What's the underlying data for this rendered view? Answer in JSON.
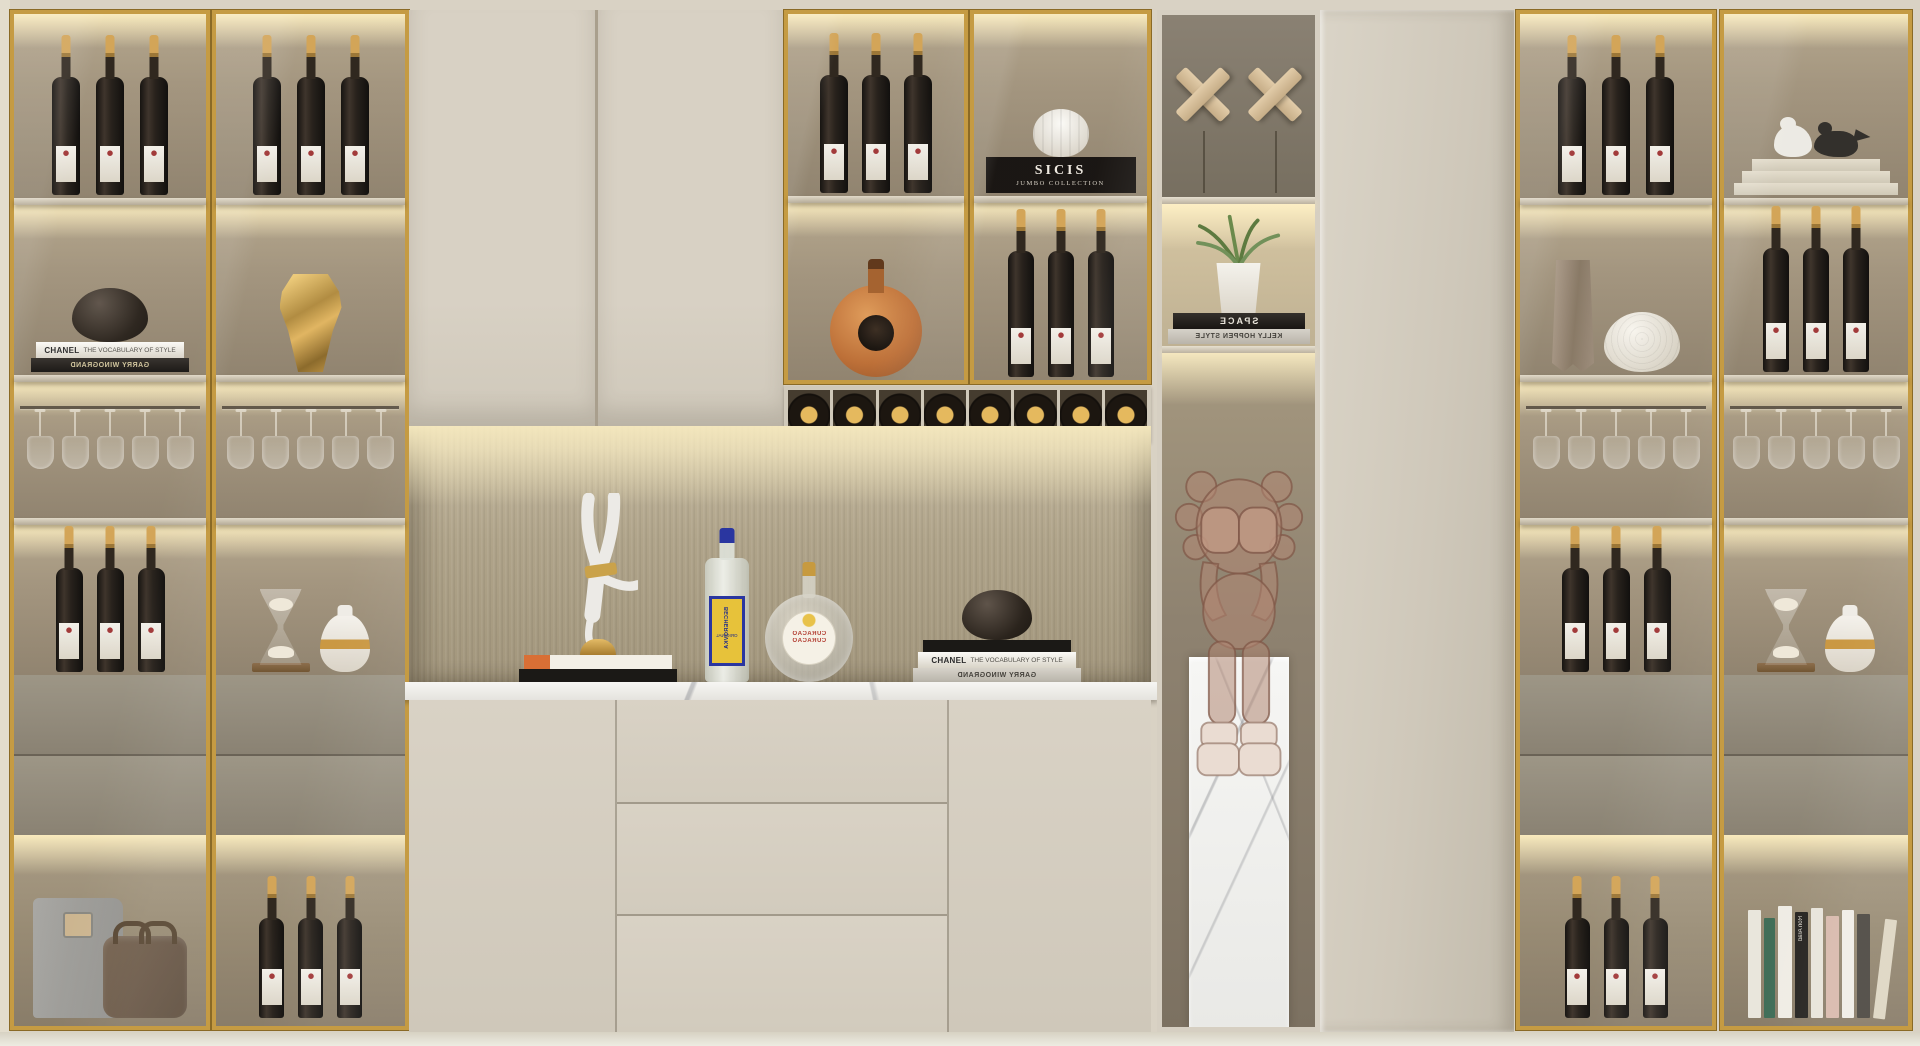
{
  "palette": {
    "wall": "#d9d2c4",
    "cabinet_cream": "#d5cec1",
    "gold_frame": "#c59b43",
    "interior_taupe": "#998b76",
    "drawer_gray": "#8f887a",
    "marble_white": "#f4f4f2",
    "warm_light": "#f6e7b8",
    "becherovka_yellow": "#e7c23a",
    "becherovka_blue": "#2a36a0"
  },
  "texts": {
    "chanel_brand": "CHANEL",
    "chanel_sub": "THE VOCABULARY OF STYLE",
    "garry": "GARRY WINOGRAND",
    "sicis_brand": "SICIS",
    "sicis_sub": "JUMBO COLLECTION",
    "space": "SPACE",
    "kelly": "KELLY HOPPEN STYLE",
    "bech_brand": "BECHEROVKA",
    "bech_sub": "ORIGINAL",
    "curacao": "CURACAO",
    "ron_arad": "Ron Arad"
  },
  "inventory": {
    "left_cabinet_1": [
      "3 red wine bottles",
      "bronze bowl on CHANEL + GARRY WINOGRAND books",
      "5 hanging stem glasses",
      "3 red wine bottles",
      "2 gray drawers",
      "garment bag and leather travel bag"
    ],
    "left_cabinet_2": [
      "3 red wine bottles",
      "gold faceted mask sculpture",
      "5 hanging stem glasses",
      "hourglass and white vase with gold band",
      "2 gray drawers",
      "3 red wine bottles"
    ],
    "center_upper": [
      "2 plain cream doors",
      "glass door: 3 wine bottles over round cognac bottle",
      "glass door: SICIS JUMBO COLLECTION book with white gourd vase over 3 wine bottles",
      "8 wine cubbies with bottles lying down"
    ],
    "center_niche": [
      "white handstand figurine on gold dome and 2 books",
      "BECHEROVKA ORIGINAL bottle",
      "CURACAO round flask",
      "dark bowl on CHANEL + GARRY WINOGRAND books"
    ],
    "center_base": [
      "left door",
      "3 wide drawers",
      "right door",
      "white marble countertop"
    ],
    "open_tower": [
      "2 X-shaped decor stands",
      "potted green plant on SPACE + KELLY HOPPEN STYLE books",
      "rose-glass collectible figure seated on white marble pedestal"
    ],
    "tall_cabinet": [
      "plain cream full-height door"
    ],
    "right_cabinet_1": [
      "3 red wine bottles",
      "tall taupe vase and white hobnail vase",
      "5 hanging stem glasses",
      "3 red wine bottles",
      "2 gray drawers",
      "3 red wine bottles"
    ],
    "right_cabinet_2": [
      "white and black bird figurines on 3 cream books",
      "3 red wine bottles",
      "5 hanging stem glasses",
      "hourglass and white vase with gold band",
      "2 gray drawers",
      "row of 9 standing books incl. Ron Arad"
    ]
  }
}
